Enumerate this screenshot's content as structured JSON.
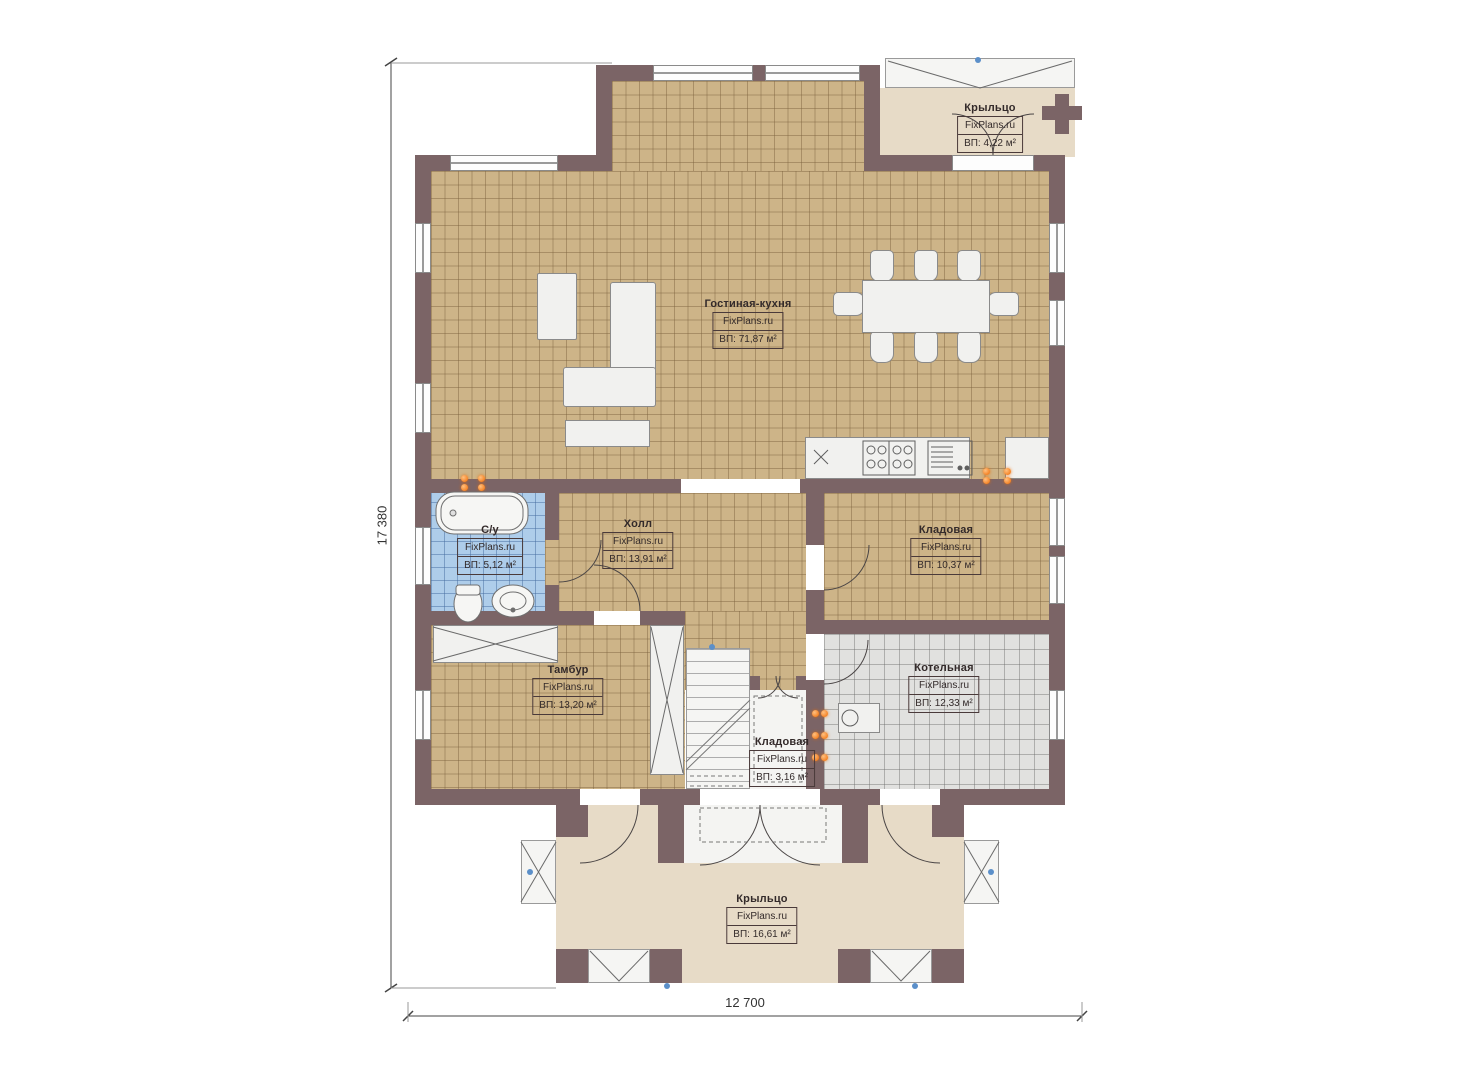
{
  "plan": {
    "title": "План 1 этажа",
    "brand": "FixPlans.ru",
    "dimensions": {
      "height_label": "17 380",
      "width_label": "12 700"
    },
    "rooms": [
      {
        "id": "porch-top",
        "name": "Крыльцо",
        "brand": "FixPlans.ru",
        "area": "ВП: 4,22 м²"
      },
      {
        "id": "living-kitchen",
        "name": "Гостиная-кухня",
        "brand": "FixPlans.ru",
        "area": "ВП: 71,87 м²"
      },
      {
        "id": "bathroom",
        "name": "С/у",
        "brand": "FixPlans.ru",
        "area": "ВП: 5,12 м²"
      },
      {
        "id": "hall",
        "name": "Холл",
        "brand": "FixPlans.ru",
        "area": "ВП: 13,91 м²"
      },
      {
        "id": "storage-big",
        "name": "Кладовая",
        "brand": "FixPlans.ru",
        "area": "ВП: 10,37 м²"
      },
      {
        "id": "vestibule",
        "name": "Тамбур",
        "brand": "FixPlans.ru",
        "area": "ВП: 13,20 м²"
      },
      {
        "id": "boiler-room",
        "name": "Котельная",
        "brand": "FixPlans.ru",
        "area": "ВП: 12,33 м²"
      },
      {
        "id": "storage-small",
        "name": "Кладовая",
        "brand": "FixPlans.ru",
        "area": "ВП: 3,16 м²"
      },
      {
        "id": "porch-bottom",
        "name": "Крыльцо",
        "brand": "FixPlans.ru",
        "area": "ВП: 16,61 м²"
      }
    ],
    "colors": {
      "wall": "#7b6466",
      "floor_tile": "#cdb488",
      "bathroom_tile": "#aecdea",
      "boiler_tile": "#e1e1df",
      "porch": "#e7dbc7",
      "radiator_marker": "#f06a00"
    }
  }
}
